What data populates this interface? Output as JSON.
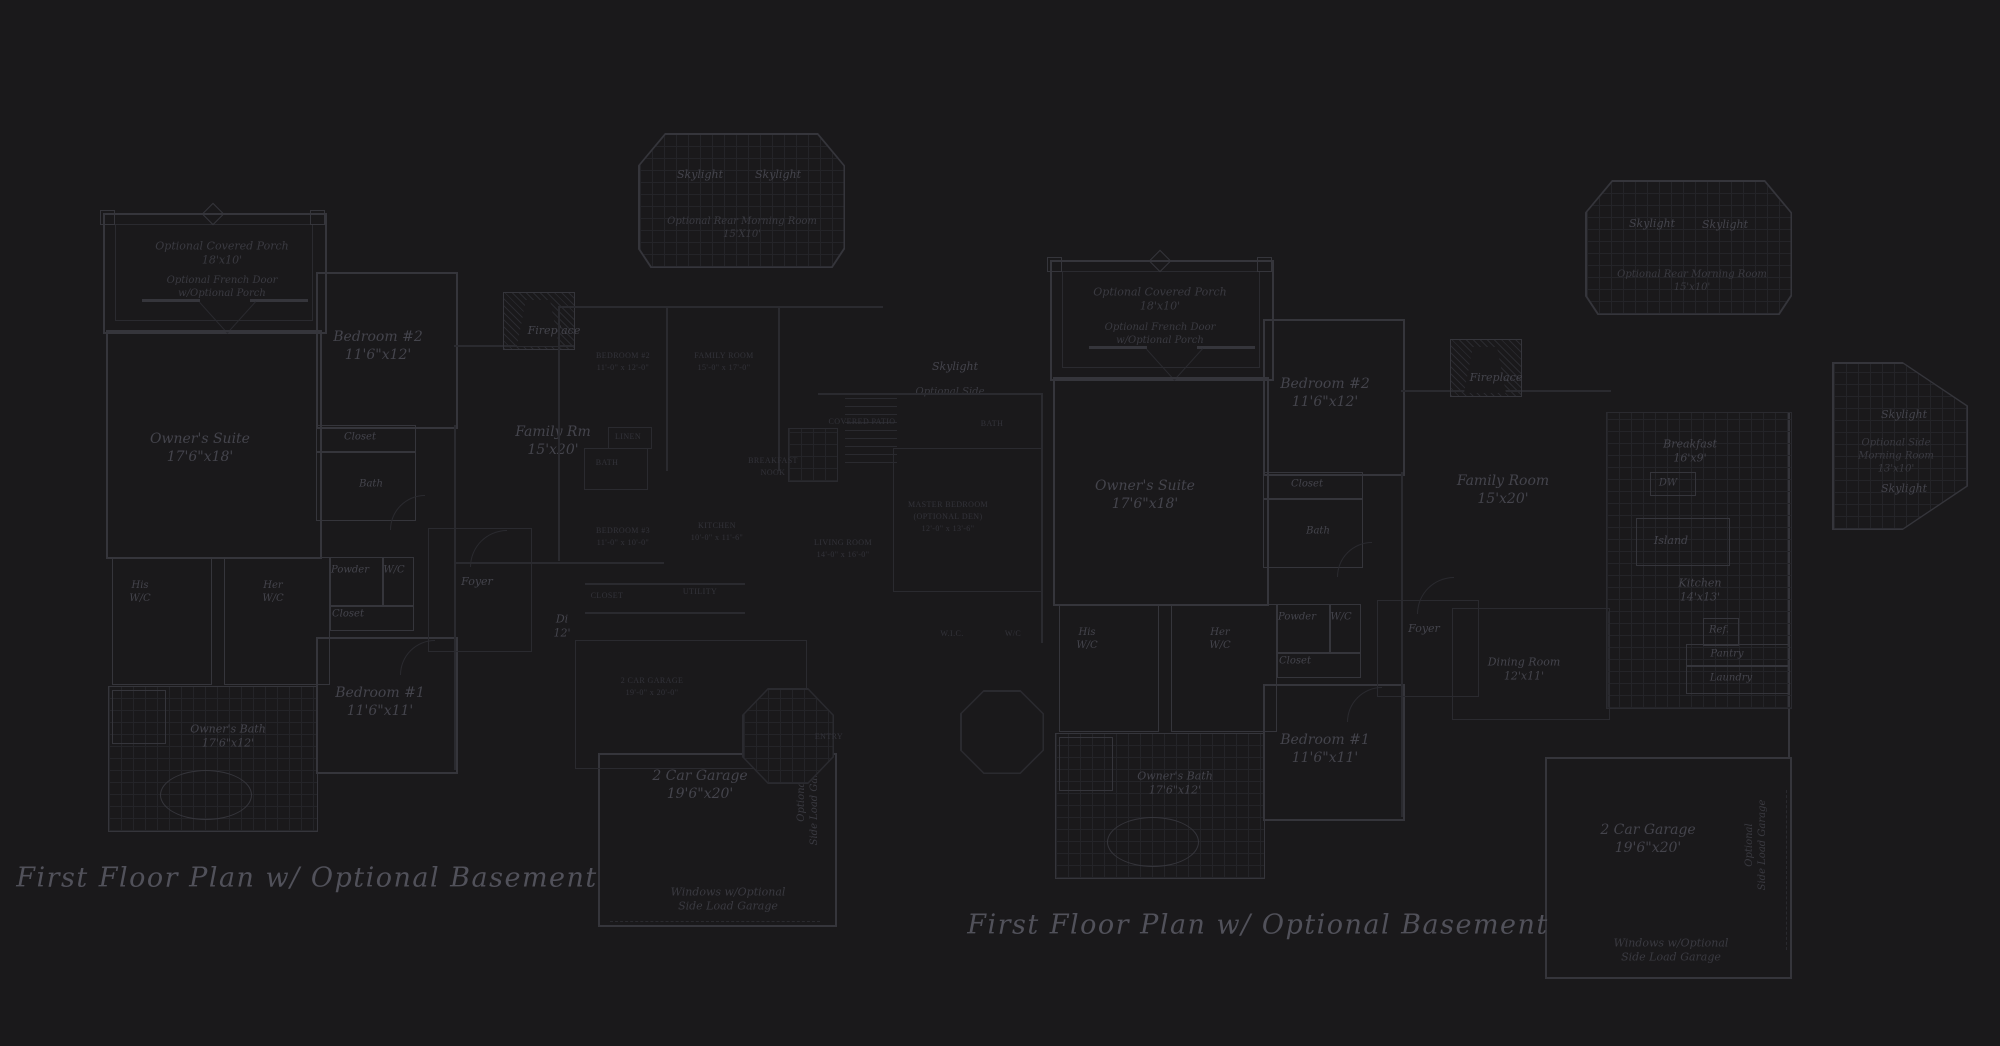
{
  "colors": {
    "bg": "#1a191b",
    "wall": "#35353b",
    "wallf": "#2a2a2f",
    "grid": "#242428",
    "ink": "#44444c",
    "inkdim": "#3a3a41",
    "caps": "#33333a",
    "title": "#51515a"
  },
  "plans": {
    "left": {
      "title": "First Floor Plan  w/ Optional Basement",
      "covered_porch": "Optional Covered Porch\n18'x10'",
      "french_door": "Optional French Door\nw/Optional Porch",
      "owners_suite": "Owner's Suite\n17'6\"x18'",
      "bedroom2": "Bedroom #2\n11'6\"x12'",
      "closet": "Closet",
      "bath": "Bath",
      "fireplace": "Fireplace",
      "family_rm": "Family Rm\n15'x20'",
      "skylight_a": "Skylight",
      "skylight_b": "Skylight",
      "rear_morning": "Optional Rear Morning Room\n15'X10'",
      "side_skylight": "Skylight",
      "side_morning": "Optional Side",
      "his_wc": "His\nW/C",
      "her_wc": "Her\nW/C",
      "powder": "Powder",
      "wc": "W/C",
      "closet2": "Closet",
      "foyer": "Foyer",
      "dining_partial": "Di\n12'",
      "bedroom1": "Bedroom #1\n11'6\"x11'",
      "owners_bath": "Owner's Bath\n17'6\"x12'",
      "garage": "2 Car Garage\n19'6\"x20'",
      "side_load": "Optional\nSide Load Garage",
      "windows_note": "Windows w/Optional\nSide Load Garage"
    },
    "overlay": {
      "bedroom2": "BEDROOM #2\n11'-0\" x 12'-0\"",
      "family_room": "FAMILY ROOM\n15'-0\" x 17'-0\"",
      "linen": "LINEN",
      "bath_upper": "BATH",
      "breakfast_nook": "BREAKFAST\nNOOK",
      "bedroom3": "BEDROOM #3\n11'-0\" x 10'-0\"",
      "kitchen": "KITCHEN\n10'-0\" x 11'-6\"",
      "living_room": "LIVING ROOM\n14'-0\" x 16'-0\"",
      "covered_patio": "COVERED PATIO",
      "bath_right": "BATH",
      "master": "MASTER BEDROOM\n(OPTIONAL DEN)\n12'-0\" x 13'-6\"",
      "closet": "CLOSET",
      "utility": "UTILITY",
      "garage": "2 CAR GARAGE\n19'-0\" x 20'-0\"",
      "wic": "W.I.C.",
      "wc": "W/C",
      "entry": "ENTRY"
    },
    "right": {
      "title": "First Floor Plan  w/ Optional Basement",
      "covered_porch": "Optional Covered Porch\n18'x10'",
      "french_door": "Optional French Door\nw/Optional Porch",
      "owners_suite": "Owner's Suite\n17'6\"x18'",
      "bedroom2": "Bedroom #2\n11'6\"x12'",
      "closet": "Closet",
      "bath": "Bath",
      "fireplace": "Fireplace",
      "family_room": "Family Room\n15'x20'",
      "skylight_a": "Skylight",
      "skylight_b": "Skylight",
      "rear_morning": "Optional Rear Morning Room\n15'x10'",
      "breakfast": "Breakfast\n16'x9'",
      "dw": "DW",
      "island": "Island",
      "kitchen": "Kitchen\n14'x13'",
      "ref": "Ref.",
      "pantry": "Pantry",
      "laundry": "Laundry",
      "side_skylight1": "Skylight",
      "side_morning": "Optional Side\nMorning Room\n13'x10'",
      "side_skylight2": "Skylight",
      "his_wc": "His\nW/C",
      "her_wc": "Her\nW/C",
      "powder": "Powder",
      "wc": "W/C",
      "closet2": "Closet",
      "foyer": "Foyer",
      "dining": "Dining Room\n12'x11'",
      "bedroom1": "Bedroom #1\n11'6\"x11'",
      "owners_bath": "Owner's Bath\n17'6\"x12'",
      "garage": "2 Car Garage\n19'6\"x20'",
      "side_load": "Optional\nSide Load Garage",
      "windows_note": "Windows w/Optional\nSide Load Garage"
    }
  }
}
